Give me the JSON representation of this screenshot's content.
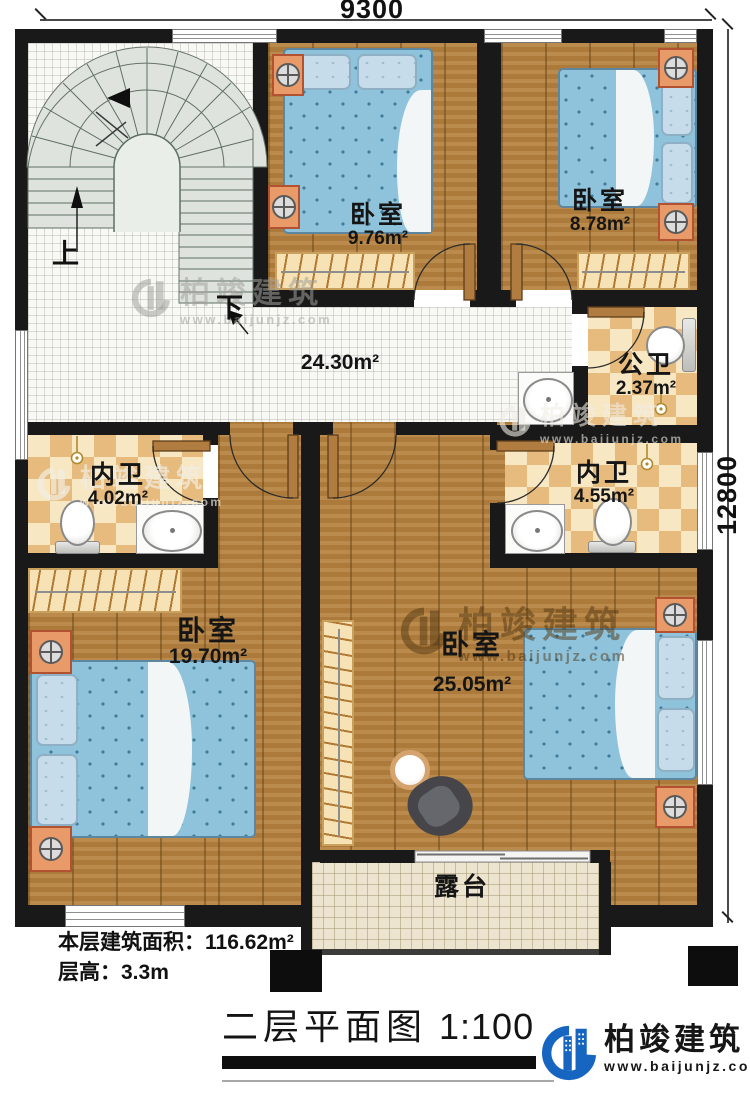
{
  "dimensions": {
    "width": "9300",
    "height": "12800"
  },
  "stairs": {
    "up": "上",
    "down": "下"
  },
  "rooms": [
    {
      "id": "bedroom-top-middle",
      "name": "卧室",
      "area": "9.76m²"
    },
    {
      "id": "bedroom-top-right",
      "name": "卧室",
      "area": "8.78m²"
    },
    {
      "id": "public-bathroom",
      "name": "公卫",
      "area": "2.37m²"
    },
    {
      "id": "hall",
      "name": "",
      "area": "24.30m²"
    },
    {
      "id": "ensuite-left",
      "name": "内卫",
      "area": "4.02m²"
    },
    {
      "id": "ensuite-right",
      "name": "内卫",
      "area": "4.55m²"
    },
    {
      "id": "bedroom-bottom-left",
      "name": "卧室",
      "area": "19.70m²"
    },
    {
      "id": "bedroom-bottom-right",
      "name": "卧室",
      "area": "25.05m²"
    },
    {
      "id": "terrace",
      "name": "露台",
      "area": ""
    }
  ],
  "footer": {
    "line1": "本层建筑面积：116.62m²",
    "line2": "层高：3.3m"
  },
  "title": {
    "text": "二层平面图",
    "scale": "1:100"
  },
  "brand": {
    "name": "柏竣建筑",
    "site": "www.baijunjz.com"
  },
  "watermark": {
    "name": "柏竣建筑",
    "site": "www.baijunjz.com"
  },
  "colors": {
    "wall": "#191919",
    "wood": "#b5823f",
    "tile_light": "#f7e7c3",
    "tile_dark": "#e6bb7d",
    "bed": "#8fc3db",
    "stair": "#dee4dd",
    "brand_blue": "#1665c1"
  }
}
